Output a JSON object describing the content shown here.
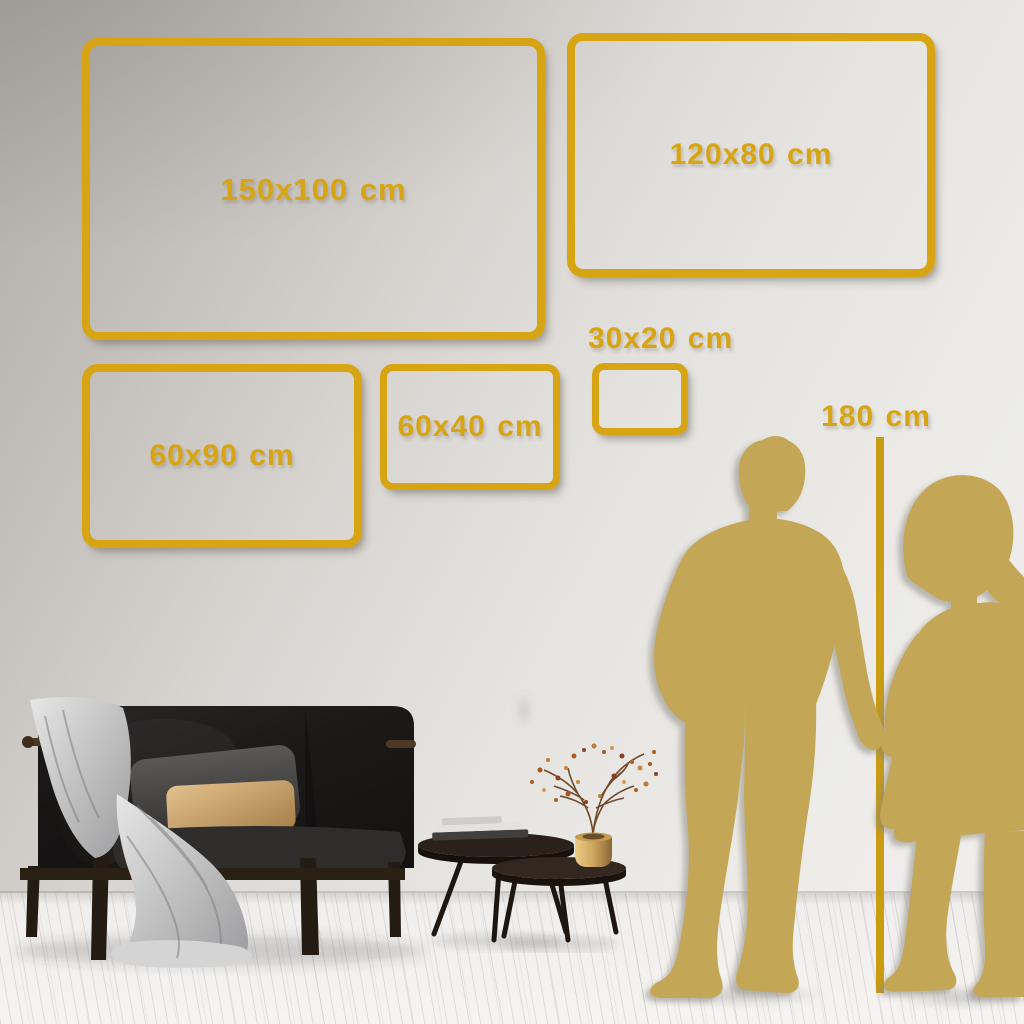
{
  "frames": [
    {
      "id": "150x100",
      "label": "150x100 cm"
    },
    {
      "id": "120x80",
      "label": "120x80 cm"
    },
    {
      "id": "60x90",
      "label": "60x90 cm"
    },
    {
      "id": "60x40",
      "label": "60x40 cm"
    },
    {
      "id": "30x20",
      "label": "30x20 cm"
    }
  ],
  "height_marker": {
    "label": "180 cm"
  },
  "colors": {
    "accent_gold": "#D7A413",
    "line_gold": "#C99C12",
    "silhouette_gold": "#C3A756",
    "wall_top": "#AEAAA5",
    "wall_light": "#EAE8E5",
    "floor": "#F2F1EF"
  }
}
